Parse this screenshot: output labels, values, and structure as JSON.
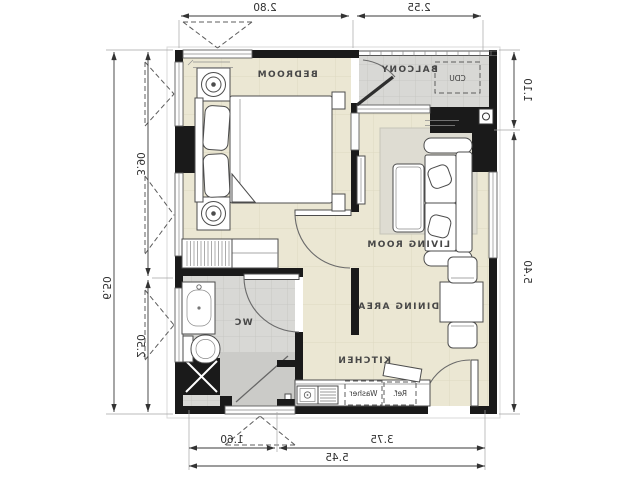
{
  "rooms": {
    "bedroom": "BEDROOM",
    "balcony": "BALCONY",
    "living": "LIVING ROOM",
    "dining": "DINING AREA",
    "kitchen": "KITCHEN",
    "wc": "WC"
  },
  "labels": {
    "cdu": "CDU",
    "washer": "Washer",
    "ref": "Ref."
  },
  "dimensions": {
    "top_bedroom": "2.80",
    "top_balcony": "2.55",
    "right_balcony": "1.10",
    "right_main": "5.40",
    "left_bedroom": "3.90",
    "left_wc": "2.50",
    "left_total": "6.50",
    "bottom_entry": "1.60",
    "bottom_kitchen": "3.75",
    "bottom_total": "5.45"
  },
  "colors": {
    "wall": "#1a1a1a",
    "ink": "#383838",
    "furn": "#4c4c4c",
    "floor": "#ebe7d3",
    "floorline": "#ded9c2",
    "tile": "#d8d8d5",
    "tileline": "#c3c3c0",
    "rug": "#dedcd2",
    "shower": "#cbcbc8",
    "bg": "#ffffff"
  }
}
